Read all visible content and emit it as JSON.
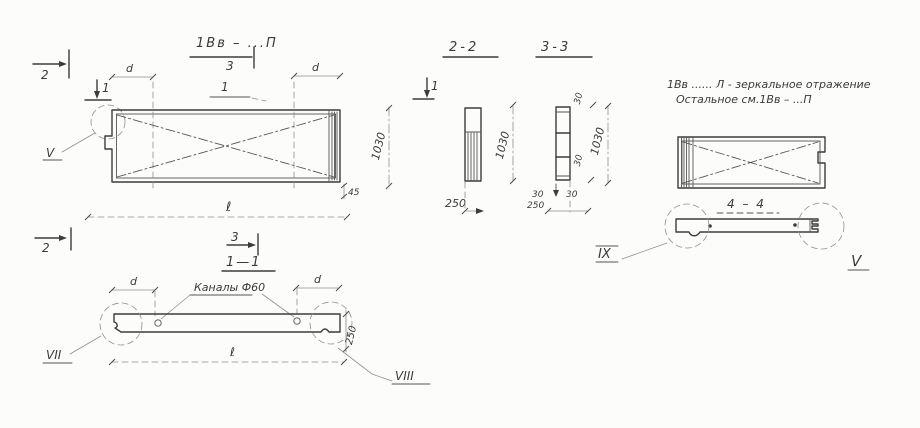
{
  "meta": {
    "background": "#fcfcfa",
    "ink_color": "#3c3c3c",
    "drawing_type": "precast panel shop drawing"
  },
  "plan": {
    "title": "1Вв – ...П",
    "cut2_top": "2",
    "cut1_top": "1",
    "cut3_top": "3",
    "detail_v": "V",
    "callout_1": "1",
    "dim_d_left": "d",
    "dim_d_right": "d",
    "dim_height": "1030",
    "dim_45": "45",
    "dim_length": "ℓ",
    "cut2_bottom": "2",
    "cut3_bottom": "3"
  },
  "section22": {
    "title": "2-2",
    "cut1": "1",
    "dim_height": "1030",
    "dim_width": "250"
  },
  "section33": {
    "title": "3-3",
    "dim_30_top": "30",
    "dim_height": "1030",
    "dim_30_mid": "30",
    "dim_30_left": "30",
    "dim_30_right": "30",
    "dim_width": "250"
  },
  "section11": {
    "title": "1—1",
    "channels": "Каналы Ф60",
    "dim_d_left": "d",
    "dim_d_right": "d",
    "dim_length": "ℓ",
    "dim_thickness": "250",
    "detail_vii": "VII",
    "detail_viii": "VIII"
  },
  "mirror": {
    "note1": "1Вв ...... Л - зеркальное отражение",
    "note2": "Остальное см.1Вв – ...П",
    "title44": "4 – 4",
    "detail_ix": "IX",
    "detail_v": "V"
  }
}
